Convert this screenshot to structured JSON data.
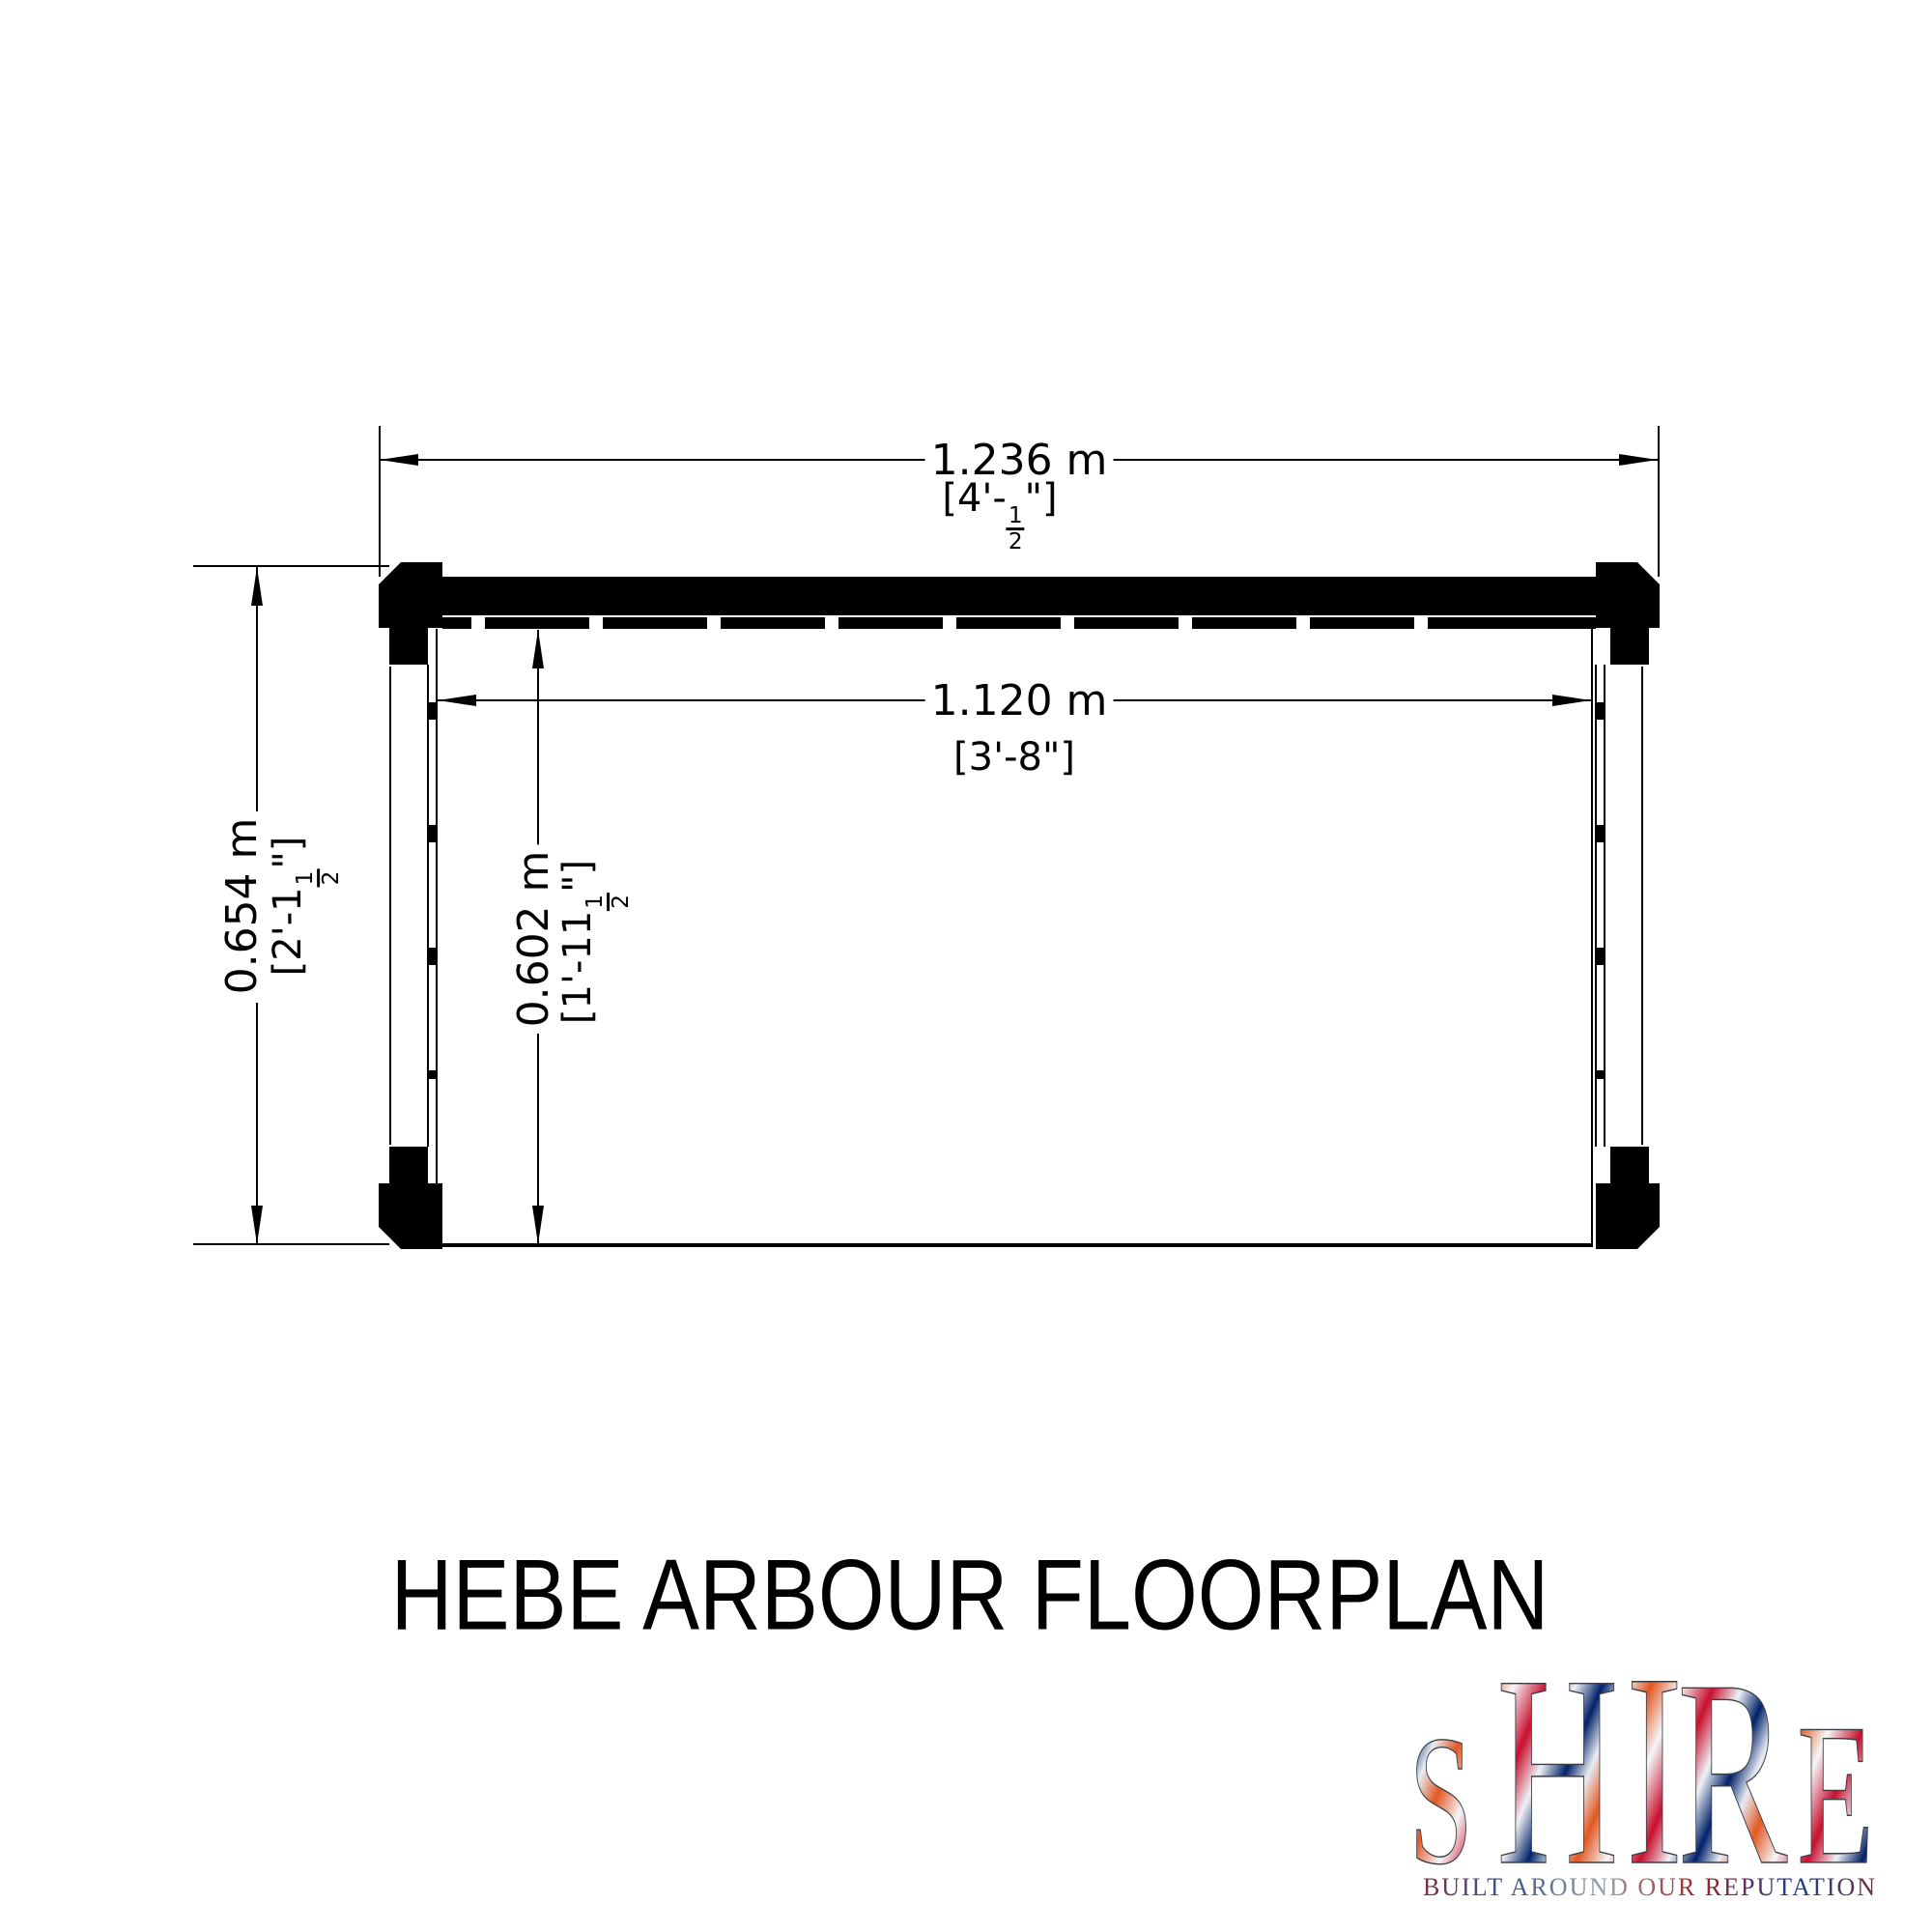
{
  "title": {
    "text": "HEBE ARBOUR FLOORPLAN"
  },
  "dims": {
    "w_outer": {
      "metric": "1.236 m",
      "imp_pre": "[4'-",
      "imp_num": "1",
      "imp_den": "2",
      "imp_post": "\"]"
    },
    "w_inner": {
      "metric": "1.120 m",
      "imp": "[3'-8\"]"
    },
    "h_outer": {
      "metric": "0.654 m",
      "imp_pre": "[2'-1",
      "imp_num": "1",
      "imp_den": "2",
      "imp_post": "\"]"
    },
    "h_inner": {
      "metric": "0.602 m",
      "imp_pre": "[1'-11",
      "imp_num": "1",
      "imp_den": "2",
      "imp_post": "\"]"
    }
  },
  "logo": {
    "letters": [
      "S",
      "H",
      "I",
      "R",
      "E"
    ],
    "tagline": "BUILT AROUND OUR REPUTATION"
  },
  "colors": {
    "line": "#000000",
    "flag_red": "#c8102e",
    "flag_blue": "#012169",
    "flag_white": "#e8edf2"
  }
}
